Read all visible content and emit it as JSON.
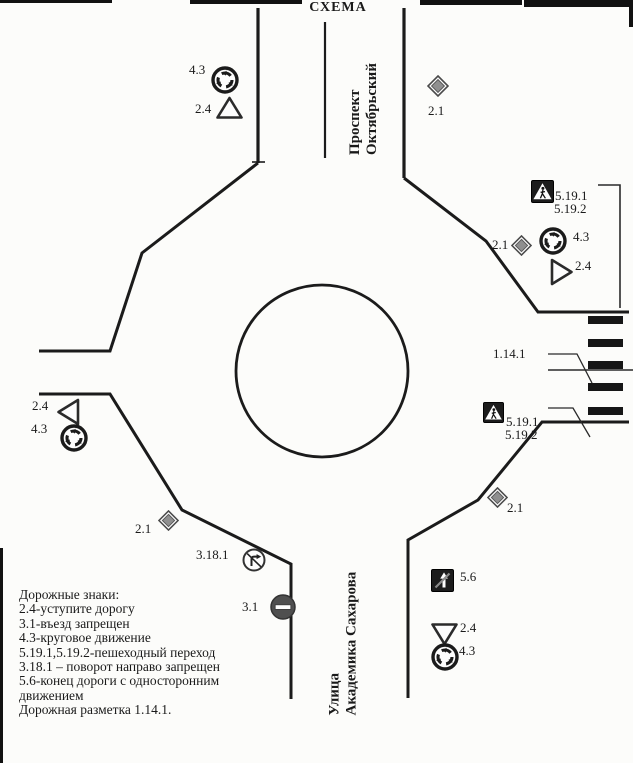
{
  "title": "СХЕМА",
  "streets": {
    "north": [
      "Проспект",
      "Октябрьский"
    ],
    "south": [
      "Улица",
      "Академика Сахарова"
    ]
  },
  "legend": [
    "Дорожные знаки:",
    "2.4-уступите дорогу",
    "3.1-въезд запрещен",
    "4.3-круговое движение",
    "5.19.1,5.19.2-пешеходный переход",
    "3.18.1 – поворот направо запрещен",
    "5.6-конец дороги с односторонним",
    "движением",
    "Дорожная разметка 1.14.1."
  ],
  "labels": {
    "nw_43": "4.3",
    "nw_24": "2.4",
    "n_21": "2.1",
    "ne_5191": "5.19.1",
    "ne_5192": "5.19.2",
    "ne_21": "2.1",
    "ne_43": "4.3",
    "ne_24": "2.4",
    "e_1141": "1.14.1",
    "see_5191": "5.19.1",
    "see_5192": "5.19.2",
    "se_21": "2.1",
    "w_24": "2.4",
    "w_43": "4.3",
    "sw_21": "2.1",
    "sw_3181": "3.18.1",
    "sw_31": "3.1",
    "s_56": "5.6",
    "s_24": "2.4",
    "s_43": "4.3"
  },
  "colors": {
    "line": "#1b1b1b",
    "sign_dark": "#1c1c1c",
    "diamond_fill": "#8f8f8f",
    "no_entry_fill": "#4f4f4f"
  }
}
